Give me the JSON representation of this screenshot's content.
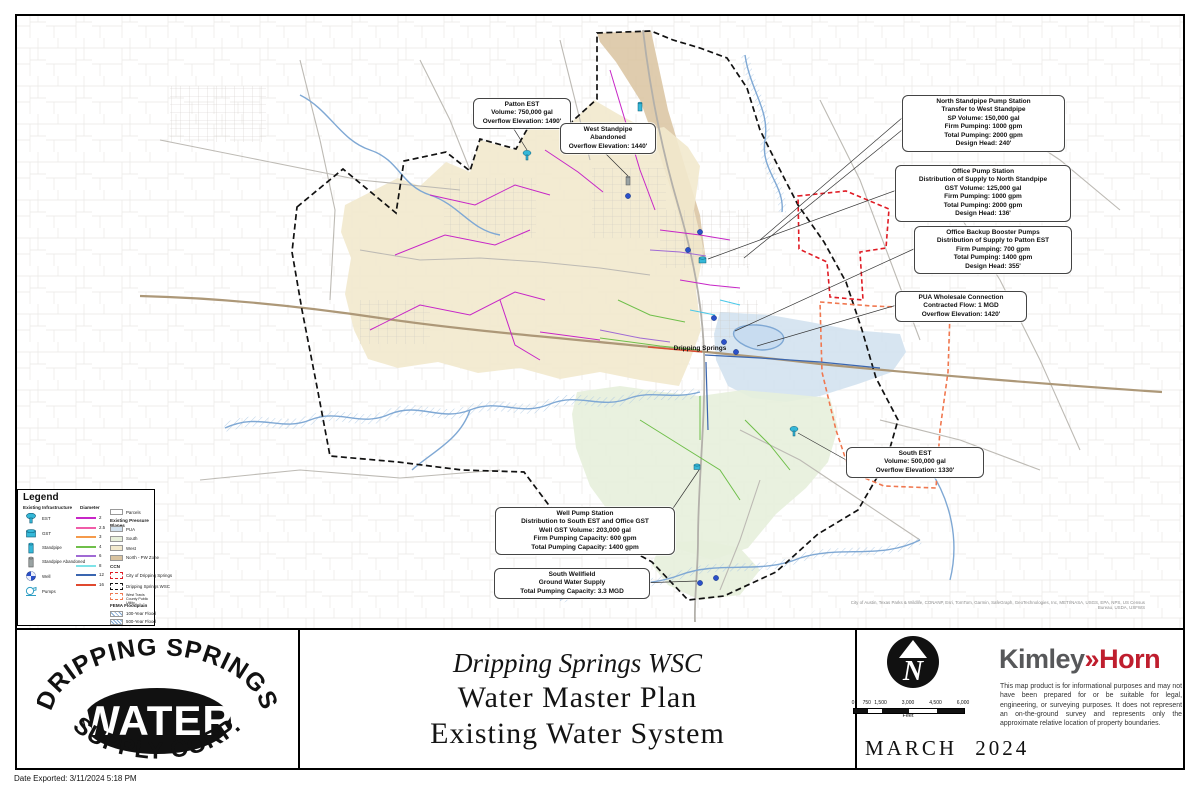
{
  "frame": {
    "date_exported": "Date Exported: 3/11/2024 5:18 PM"
  },
  "map": {
    "town_label": "Dripping Springs",
    "attribution": "City of Austin, Texas Parks & Wildlife, CONANP, Esri, TomTom, Garmin, SafeGraph, GeoTechnologies, Inc, METI/NASA, USGS, EPA, NPS, US Census Bureau, USDA, USFWS"
  },
  "callouts": {
    "patton_est": {
      "lines": [
        "Patton EST",
        "Volume: 750,000 gal",
        "Overflow Elevation: 1490'"
      ]
    },
    "west_standpipe": {
      "lines": [
        "West Standpipe",
        "Abandoned",
        "Overflow Elevation: 1440'"
      ]
    },
    "north_standpipe": {
      "lines": [
        "North Standpipe Pump Station",
        "Transfer to West Standpipe",
        "SP Volume: 150,000 gal",
        "Firm Pumping: 1000 gpm",
        "Total Pumping: 2000 gpm",
        "Design Head: 240'"
      ]
    },
    "office_pump": {
      "lines": [
        "Office Pump Station",
        "Distribution of Supply to North Standpipe",
        "GST Volume: 125,000 gal",
        "Firm Pumping: 1000 gpm",
        "Total Pumping: 2000 gpm",
        "Design Head: 136'"
      ]
    },
    "office_backup": {
      "lines": [
        "Office Backup Booster Pumps",
        "Distribution of Supply to Patton EST",
        "Firm Pumping: 700 gpm",
        "Total Pumping: 1400 gpm",
        "Design Head: 355'"
      ]
    },
    "pua_wholesale": {
      "lines": [
        "PUA Wholesale Connection",
        "Contracted Flow: 1 MGD",
        "Overflow Elevation: 1420'"
      ]
    },
    "south_est": {
      "lines": [
        "South EST",
        "Volume: 500,000 gal",
        "Overflow Elevation: 1330'"
      ]
    },
    "well_pump": {
      "lines": [
        "Well Pump Station",
        "Distribution to South EST and Office GST",
        "Well GST Volume: 203,000 gal",
        "Firm Pumping Capacity: 600 gpm",
        "Total Pumping Capacity: 1400 gpm"
      ]
    },
    "south_wellfield": {
      "lines": [
        "South Wellfield",
        "Ground Water Supply",
        "Total Pumping Capacity: 3.3 MGD"
      ]
    }
  },
  "legend": {
    "title": "Legend",
    "infrastructure_header": "Existing Infrastructure",
    "diameter_header": "Diameter",
    "infrastructure": [
      {
        "label": "EST"
      },
      {
        "label": "GST"
      },
      {
        "label": "Standpipe"
      },
      {
        "label": "Standpipe Abandoned"
      },
      {
        "label": "Well"
      },
      {
        "label": "Pumps"
      }
    ],
    "diameters": [
      {
        "label": "2",
        "color": "#c726c7"
      },
      {
        "label": "2.5",
        "color": "#f05ca8"
      },
      {
        "label": "3",
        "color": "#f59a4b"
      },
      {
        "label": "4",
        "color": "#6fbf4a"
      },
      {
        "label": "6",
        "color": "#a06ad4"
      },
      {
        "label": "8",
        "color": "#7fe3e8"
      },
      {
        "label": "12",
        "color": "#3a66b0"
      },
      {
        "label": "16",
        "color": "#e0492f"
      }
    ],
    "parcels_label": "Parcels",
    "pressure_planes_header": "Existing Pressure Planes",
    "pressure_planes": [
      {
        "label": "PUA",
        "color": "#d3e2ef"
      },
      {
        "label": "South",
        "color": "#e7efdb"
      },
      {
        "label": "West",
        "color": "#f2e9cd"
      },
      {
        "label": "North - PW Zone",
        "color": "#d9c3a0"
      }
    ],
    "ccn_header": "CCN",
    "ccn": [
      {
        "label": "City of Dripping Springs",
        "color": "#e01b24"
      },
      {
        "label": "Dripping Springs WSC",
        "color": "#111111"
      },
      {
        "label": "West Travis County Public Utility",
        "color": "#f07850"
      }
    ],
    "fema_header": "FEMA Floodplain",
    "fema": [
      {
        "label": "100-Year Flood",
        "color": "#7fa8d4"
      },
      {
        "label": "500-Year Flood",
        "color": "#7fa8d4"
      }
    ]
  },
  "title_block": {
    "logo": {
      "arc_top": "DRIPPING SPRINGS",
      "center": "WATER",
      "arc_bottom": "SUPPLY CORP."
    },
    "title_line1": "Dripping Springs WSC",
    "title_line2": "Water Master Plan",
    "title_line3": "Existing Water System",
    "north_letter": "N",
    "scale": {
      "ticks": [
        "0",
        "750",
        "1,500",
        "3,000",
        "4,500",
        "6,000"
      ],
      "unit": "Feet"
    },
    "date": "MARCH 2024",
    "firm": {
      "name1": "Kimley",
      "sep": "»",
      "name2": "Horn",
      "color": "#bf1e2e"
    },
    "disclaimer": "This map product is for informational purposes and may not have been prepared for or be suitable for legal, engineering, or surveying purposes. It does not represent an on-the-ground survey and represents only the approximate relative location of property boundaries."
  }
}
